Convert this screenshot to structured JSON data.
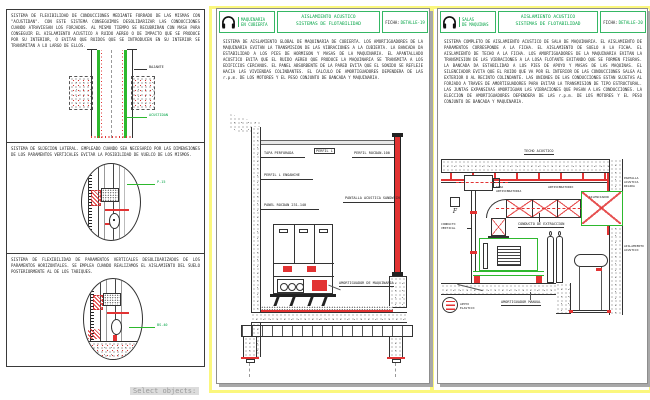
{
  "command_line": {
    "prompt": "Select objects:"
  },
  "colors": {
    "cad_green": "#00a344",
    "cad_red": "#e23333",
    "frame_yellow": "#fbf77d"
  },
  "left_sheet": {
    "sections": [
      {
        "text": "SISTEMA DE FLEXIBILIDAD DE CONDUCCIONES MEDIANTE FORRADO DE LAS MISMAS CON \"ACUSTIDAN\". CON ESTE SISTEMA CONSEGUIMOS DESOLIDARIZAR LAS CONDUCCIONES CUANDO ATRAVIESAN LOS FORJADOS. AL MISMO TIEMPO SE RECUBRIRAN CON MASA PARA CONSEGUIR EL AISLAMIENTO ACUSTICO A RUIDO AEREO O DE IMPACTO QUE SE PRODUCE POR SU INTERIOR, O EVITAR QUE RUIDOS QUE SE INTRODUCEN EN SU INTERIOR SE TRANSMITAN A LO LARGO DE ELLOS.",
        "labels": {
          "bajante": "BAJANTE",
          "acustidan": "ACUSTIDAN"
        }
      },
      {
        "text": "SISTEMA DE SUJECION LATERAL. EMPLEADO CUANDO SEA NECESARIO POR LAS DIMENSIONES DE LOS PARAMENTOS VERTICALES EVITAR LA POSIBILIDAD DE VUELCO DE LOS MISMOS.",
        "labels": {
          "detail_ref": "P-15"
        }
      },
      {
        "text": "SISTEMA DE FLEXIBILIDAD DE PARAMENTOS VERTICALES DESOLIDARIZADOS DE LOS PARAMENTOS HORIZONTALES. SE EMPLEA CUANDO REALIZAMOS EL AISLAMIENTO DEL SUELO POSTERIORMENTE AL DE LOS TABIQUES.",
        "labels": {
          "detail_ref": "BS-40"
        }
      }
    ]
  },
  "middle_sheet": {
    "header": {
      "caption1": "MAQUINARIA",
      "caption2": "EN CUBIERTA",
      "title1": "AISLAMIENTO ACUSTICO",
      "title2": "SISTEMAS DE FLOTABILIDAD",
      "ficha_label": "FICHA:",
      "ficha_value": "DETALLE-19"
    },
    "description": "SISTEMA DE AISLAMIENTO GLOBAL DE MAQUINARIA DE CUBIERTA. LOS AMORTIGUADORES DE LA MAQUINARIA EVITAN LA TRANSMISION DE LAS VIBRACIONES A LA CUBIERTA. LA BANCADA DA ESTABILIDAD A LOS PIES DE HORMIGON Y MASAS DE LA MAQUINARIA. EL APANTALLADO ACUSTICO EVITA QUE EL RUIDO AEREO QUE PRODUCE LA MAQUINARIA SE TRANSMITA A LOS EDIFICIOS CERCANOS. EL PANEL ABSORBENTE DE LA PARED EVITA QUE EL SONIDO SE REFLEJE HACIA LAS VIVIENDAS COLINDANTES. EL CALCULO DE AMORTIGUADORES DEPENDERA DE LAS r.p.m. DE LOS MOTORES Y EL PESO CONJUNTO DE BANCADA Y MAQUINARIA.",
    "labels": {
      "perfil_l": "PERFIL L",
      "tapa": "TAPA PERFORADA",
      "enganche": "PERFIL L ENGANCHE",
      "panel": "PANEL ROCDAN 231-140",
      "perfil_rocdan": "PERFIL ROCDAN-100",
      "pantalla": "PANTALLA ACUSTICA SANDWICH",
      "amortiguador": "AMORTIGUADOR DE MAQUINARIA"
    }
  },
  "right_sheet": {
    "header": {
      "caption1": "SALAS",
      "caption2": "DE MAQUINAS",
      "title1": "AISLAMIENTO ACUSTICO",
      "title2": "SISTEMAS DE FLOTABILIDAD",
      "ficha_label": "FICHA:",
      "ficha_value": "DETALLE-20"
    },
    "description": "SISTEMA COMPLETO DE AISLAMIENTO ACUSTICO DE SALA DE MAQUINARIA. EL AISLAMIENTO DE PARAMENTOS CORRESPONDE A LA FICHA. EL AISLAMIENTO DE SUELO A LA FICHA. EL AISLAMIENTO DE TECHO A LA FICHA. LOS AMORTIGUADORES DE LA MAQUINARIA EVITAN LA TRANSMISION DE LAS VIBRACIONES A LA LOSA FLOTANTE EVITANDO QUE SE FORMEN FISURAS. LA BANCADA DA ESTABILIDAD A LOS PIES DE APOYO Y MASAS DE LAS MAQUINAS. EL SILENCIADOR EVITA QUE EL RUIDO QUE VA POR EL INTERIOR DE LAS CONDUCCIONES SALGA AL EXTERIOR O AL RECINTO COLINDANTE. LAS UNIONES DE LAS CONDUCCIONES ESTAN SUJETAS AL FORJADO A TRAVES DE AMORTIGUADORES PARA EVITAR LA TRANSMISION DE TIPO ESTRUCTURAL. LAS JUNTAS EXPANSIVAS AMORTIGUAN LAS VIBRACIONES QUE PASAN A LAS CONDUCCIONES. LA ELECCION DE AMORTIGUADORES DEPENDERA DE LAS r.p.m. DE LOS MOTORES Y EL PESO CONJUNTO DE BANCADA Y MAQUINARIA.",
    "labels": {
      "techo": "TECHO ACUSTICO",
      "tira": "TIRA ANTIVIBRATORIA",
      "antivib": "ANTIVIBRATORIO",
      "pantalla": "PANTALLA ACUSTICA RIGIDA",
      "silenciador": "SILENCIADOR",
      "conducto": "CONDUCTO DE EXTRACCION",
      "vertical": "CONDUCTO VERTICAL",
      "aislamiento": "AISLAMIENTO ACUSTICO",
      "amortiguador": "AMORTIGUADOR MANUAL",
      "apoyo": "APOYO ELASTICO",
      "f": "F"
    }
  }
}
